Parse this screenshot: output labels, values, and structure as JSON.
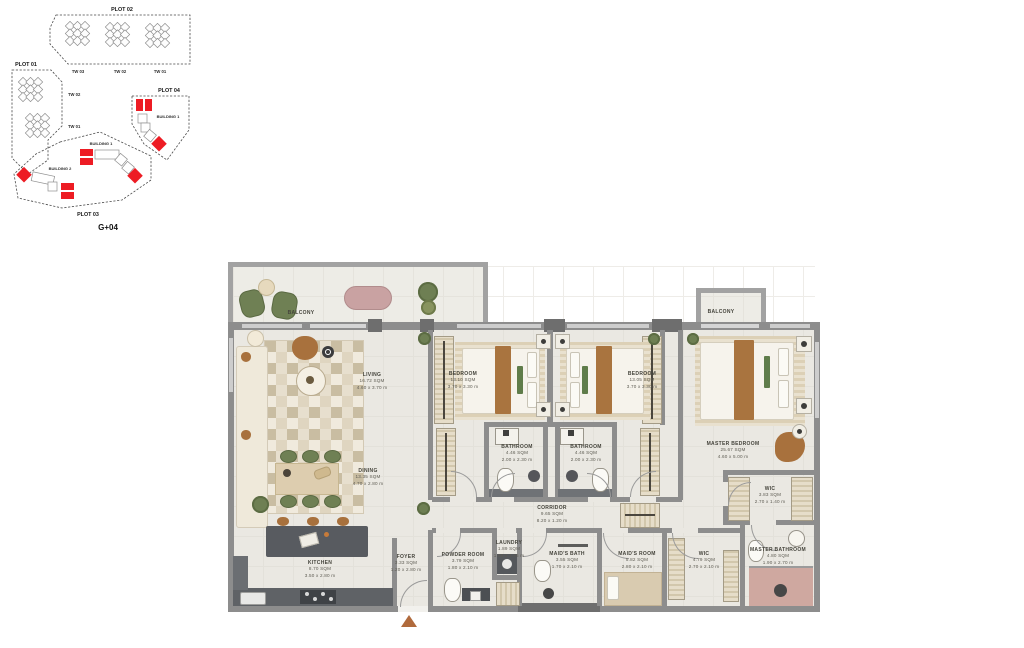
{
  "site_plan": {
    "plot_01": "PLOT 01",
    "plot_02": "PLOT 02",
    "plot_03": "PLOT 03",
    "plot_04": "PLOT 04",
    "tw_03_top": "TW 03",
    "tw_02_top": "TW 02",
    "tw_01_top": "TW 01",
    "tw_02_left": "TW 02",
    "tw_01_left": "TW 01",
    "building_1_plot04": "BUILDING 1",
    "building_1_plot03": "BUILDING 1",
    "building_2_plot03": "BUILDING 2",
    "floor_label": "G+04"
  },
  "floor_plan": {
    "rooms": {
      "balcony_living": {
        "name": "BALCONY"
      },
      "living": {
        "name": "LIVING",
        "area": "16.72 SQM",
        "dims": "4.60 x 3.70 m"
      },
      "dining": {
        "name": "DINING",
        "area": "13.35 SQM",
        "dims": "4.70 x 2.80 m"
      },
      "kitchen": {
        "name": "KITCHEN",
        "area": "8.70 SQM",
        "dims": "3.50 x 2.80 m"
      },
      "bedroom_1": {
        "name": "BEDROOM",
        "area": "13.10 SQM",
        "dims": "3.70 x 3.30 m"
      },
      "bedroom_2": {
        "name": "BEDROOM",
        "area": "13.05 SQM",
        "dims": "3.70 x 3.30 m"
      },
      "bathroom_1": {
        "name": "BATHROOM",
        "area": "4.46 SQM",
        "dims": "2.00 x 2.30 m"
      },
      "bathroom_2": {
        "name": "BATHROOM",
        "area": "4.46 SQM",
        "dims": "2.00 x 2.30 m"
      },
      "master_bedroom": {
        "name": "MASTER BEDROOM",
        "area": "25.67 SQM",
        "dims": "4.60 x 5.00 m"
      },
      "balcony_master": {
        "name": "BALCONY"
      },
      "wic_master": {
        "name": "WIC",
        "area": "3.83 SQM",
        "dims": "2.70 x 1.40 m"
      },
      "wic_2": {
        "name": "WIC",
        "area": "4.79 SQM",
        "dims": "2.70 x 2.10 m"
      },
      "master_bathroom": {
        "name": "MASTER BATHROOM",
        "area": "4.80 SQM",
        "dims": "1.90 x 2.70 m"
      },
      "corridor": {
        "name": "CORRIDOR",
        "area": "9.65 SQM",
        "dims": "8.20 x 1.20 m"
      },
      "foyer": {
        "name": "FOYER",
        "area": "3.33 SQM",
        "dims": "1.20 x 2.80 m"
      },
      "powder_room": {
        "name": "POWDER ROOM",
        "area": "3.79 SQM",
        "dims": "1.80 x 2.10 m"
      },
      "laundry": {
        "name": "LAUNDRY",
        "area": "1.89 SQM",
        "dims": "1.80 x 1.05 m"
      },
      "maids_bath": {
        "name": "MAID'S BATH",
        "area": "3.55 SQM",
        "dims": "1.70 x 2.10 m"
      },
      "maids_room": {
        "name": "MAID'S ROOM",
        "area": "5.82 SQM",
        "dims": "2.80 x 2.10 m"
      }
    }
  },
  "colors": {
    "highlight_red": "#ed1c24",
    "wall_grey": "#8d8d8d",
    "floor": "#eae8e2",
    "accent_green": "#6f8054",
    "accent_brown": "#a9743f",
    "bath_pink": "#cfa8a0"
  }
}
